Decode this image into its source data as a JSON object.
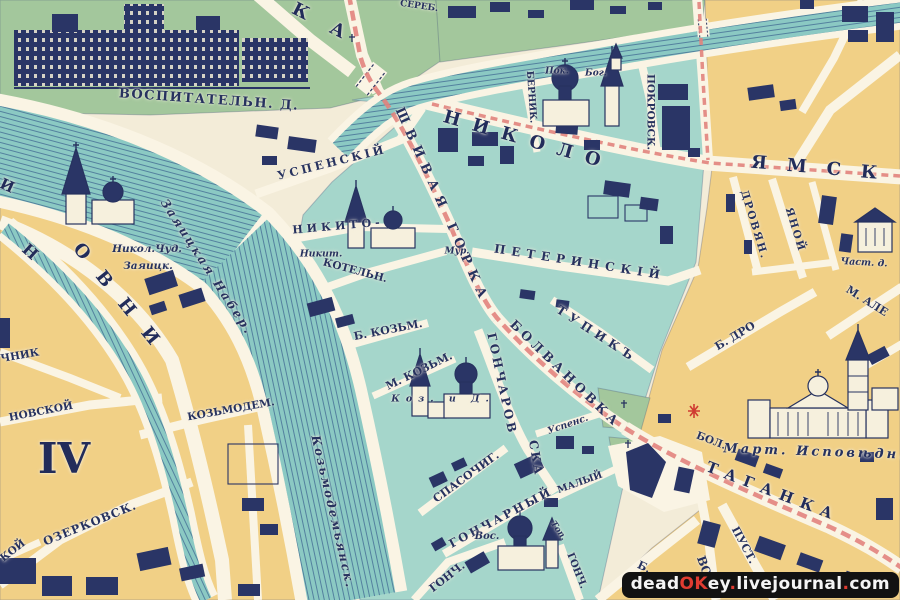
{
  "map": {
    "type": "historical-city-map",
    "district_number": "IV",
    "colors": {
      "parchment": "#f3ecd8",
      "street": "#faf4e4",
      "block_yellow": "#f1d086",
      "block_teal": "#a5d6cb",
      "block_green": "#a3c79c",
      "water": "#8bc9c3",
      "water_line": "#3c6490",
      "ink": "#27325f",
      "road_pink": "#e2837d",
      "accent_red": "#cf3a31",
      "watermark_bg": "#121212",
      "watermark_white": "#f5f5f5",
      "watermark_red": "#e03c31"
    },
    "labels": [
      {
        "name": "street-letter-partial",
        "text": "И",
        "x": 7,
        "y": 186,
        "rot": 25,
        "size": 15,
        "cls": "big"
      },
      {
        "name": "street-letter-n",
        "text": "Н",
        "x": 30,
        "y": 252,
        "rot": 42,
        "size": 16,
        "cls": "big"
      },
      {
        "name": "street-sadovnicheskaya-letters",
        "text": "ОВНИ",
        "x": 122,
        "y": 302,
        "rot": 51,
        "size": 18,
        "cls": "big",
        "sp": 20
      },
      {
        "name": "street-solyanka-letters",
        "text": "КА",
        "x": 330,
        "y": 27,
        "rot": 27,
        "size": 18,
        "cls": "big",
        "sp": 26
      },
      {
        "name": "label-vospitatelny-dom",
        "text": "ВОСПИТАТЕЛЬН. Д.",
        "x": 209,
        "y": 100,
        "rot": 4,
        "size": 13,
        "cls": "caps",
        "sp": 1.5
      },
      {
        "name": "street-serebryanicheskaya",
        "text": "СЕРЕБ.",
        "x": 419,
        "y": 7,
        "rot": 8,
        "size": 9,
        "cls": "caps"
      },
      {
        "name": "street-nikolo-letters",
        "text": "НИКОЛО",
        "x": 528,
        "y": 141,
        "rot": 16,
        "size": 18,
        "cls": "big",
        "sp": 13
      },
      {
        "name": "street-yamskaya-letters",
        "text": "ЯМСК",
        "x": 824,
        "y": 169,
        "rot": 5,
        "size": 18,
        "cls": "big",
        "sp": 20
      },
      {
        "name": "street-shvivaya-gorka",
        "text": "ШВИВАЯ ГОРКА",
        "x": 442,
        "y": 206,
        "rot": 66,
        "size": 13,
        "cls": "caps",
        "sp": 7
      },
      {
        "name": "street-bolvanovka",
        "text": "БОЛВАНОВКА",
        "x": 565,
        "y": 374,
        "rot": 44,
        "size": 12.5,
        "cls": "caps",
        "sp": 4
      },
      {
        "name": "street-taganka-letters",
        "text": "ТАГАНКА",
        "x": 773,
        "y": 492,
        "rot": 21,
        "size": 15,
        "cls": "big",
        "sp": 8
      },
      {
        "name": "street-bolshaya",
        "text": "БОЛ.",
        "x": 711,
        "y": 441,
        "rot": 21,
        "size": 10.5,
        "cls": "caps"
      },
      {
        "name": "church-martin-ispovednik-label",
        "text": "Март. Исповѣдн.",
        "x": 815,
        "y": 452,
        "rot": 2,
        "size": 13,
        "cls": "it",
        "sp": 3
      },
      {
        "name": "street-pustaya",
        "text": "ПУСТ.",
        "x": 744,
        "y": 545,
        "rot": 62,
        "size": 11,
        "cls": "caps"
      },
      {
        "name": "street-vorontsovskaya",
        "text": "ВО",
        "x": 704,
        "y": 566,
        "rot": 70,
        "size": 12,
        "cls": "caps"
      },
      {
        "name": "street-b-label",
        "text": "Б.",
        "x": 644,
        "y": 567,
        "rot": 25,
        "size": 11,
        "cls": "caps"
      },
      {
        "name": "street-tupik",
        "text": "ТУПИКЪ",
        "x": 597,
        "y": 334,
        "rot": 33,
        "size": 12,
        "cls": "caps",
        "sp": 5
      },
      {
        "name": "street-peterinsky",
        "text": "ПЕТЕРИНСКІЙ",
        "x": 580,
        "y": 262,
        "rot": 9,
        "size": 12,
        "cls": "caps",
        "sp": 6
      },
      {
        "name": "street-goncharovskaya",
        "text": "ГОНЧАРОВ",
        "x": 502,
        "y": 384,
        "rot": 78,
        "size": 12,
        "cls": "caps",
        "sp": 3
      },
      {
        "name": "street-goncharovskaya-2",
        "text": "СКА",
        "x": 536,
        "y": 458,
        "rot": 80,
        "size": 12,
        "cls": "caps",
        "sp": 2
      },
      {
        "name": "street-uspensky",
        "text": "УСПЕНСКІЙ",
        "x": 332,
        "y": 163,
        "rot": -14,
        "size": 11.5,
        "cls": "caps",
        "sp": 3
      },
      {
        "name": "street-nikito",
        "text": "НИКИТО-",
        "x": 338,
        "y": 226,
        "rot": -5,
        "size": 11,
        "cls": "caps",
        "sp": 4
      },
      {
        "name": "church-nikity-label",
        "text": "Никит.",
        "x": 321,
        "y": 254,
        "rot": 0,
        "size": 9.5,
        "cls": "it"
      },
      {
        "name": "label-mur",
        "text": "Мур.",
        "x": 457,
        "y": 252,
        "rot": 0,
        "size": 9,
        "cls": "it"
      },
      {
        "name": "street-kotelnichesky",
        "text": "КОТЕЛЬН.",
        "x": 355,
        "y": 271,
        "rot": 15,
        "size": 10.5,
        "cls": "caps"
      },
      {
        "name": "street-pokrovsky",
        "text": "ПОКРОВСК.",
        "x": 650,
        "y": 112,
        "rot": 90,
        "size": 10.5,
        "cls": "caps"
      },
      {
        "name": "street-bernikovsky",
        "text": "БЕРНИК.",
        "x": 531,
        "y": 97,
        "rot": 86,
        "size": 9.5,
        "cls": "caps"
      },
      {
        "name": "church-pokrova-label",
        "text": "Пок.",
        "x": 557,
        "y": 72,
        "rot": 0,
        "size": 9,
        "cls": "it"
      },
      {
        "name": "church-bogoroditsy-label",
        "text": "Бог.",
        "x": 596,
        "y": 74,
        "rot": 0,
        "size": 9,
        "cls": "it"
      },
      {
        "name": "street-b-kozmodemyansky",
        "text": "Б. КОЗЬМ.",
        "x": 388,
        "y": 330,
        "rot": -11,
        "size": 11,
        "cls": "caps"
      },
      {
        "name": "street-m-kozmodemyansky",
        "text": "М. КОЗЬМ.",
        "x": 419,
        "y": 371,
        "rot": -26,
        "size": 11,
        "cls": "caps"
      },
      {
        "name": "church-kozmy-i-damiana-label",
        "text": "Коз. и Д.",
        "x": 443,
        "y": 399,
        "rot": 0,
        "size": 9.5,
        "cls": "it",
        "sp": 6
      },
      {
        "name": "street-spasochigasovsky",
        "text": "СПАСОЧИГ.",
        "x": 466,
        "y": 477,
        "rot": -36,
        "size": 11,
        "cls": "caps"
      },
      {
        "name": "street-goncharny",
        "text": "ГОНЧАРНЫЙ",
        "x": 501,
        "y": 518,
        "rot": -28,
        "size": 11.5,
        "cls": "caps",
        "sp": 2.5
      },
      {
        "name": "street-maly",
        "text": "МАЛЫЙ",
        "x": 580,
        "y": 483,
        "rot": -20,
        "size": 9.5,
        "cls": "caps"
      },
      {
        "name": "label-uspens",
        "text": "Успенс.",
        "x": 568,
        "y": 425,
        "rot": -19,
        "size": 9.5,
        "cls": "it"
      },
      {
        "name": "church-voskreseniya-label",
        "text": "Вос.",
        "x": 487,
        "y": 537,
        "rot": 0,
        "size": 10,
        "cls": "it"
      },
      {
        "name": "street-goncharnaya",
        "text": "ГОНЧ.",
        "x": 447,
        "y": 577,
        "rot": -38,
        "size": 11,
        "cls": "caps"
      },
      {
        "name": "street-gonch-2",
        "text": "ГОНЧ.",
        "x": 576,
        "y": 571,
        "rot": 68,
        "size": 10,
        "cls": "caps"
      },
      {
        "name": "label-top",
        "text": "Топ.",
        "x": 558,
        "y": 531,
        "rot": 55,
        "size": 8.5,
        "cls": "it"
      },
      {
        "name": "street-zayaitskaya-nab",
        "text": "Заяицкая Набер.",
        "x": 207,
        "y": 267,
        "rot": 57,
        "size": 12,
        "cls": "it",
        "sp": 2.5
      },
      {
        "name": "street-kozmodemyanskaya-nab",
        "text": "Козьмодемьянск.",
        "x": 333,
        "y": 512,
        "rot": 77,
        "size": 12,
        "cls": "it",
        "sp": 2
      },
      {
        "name": "street-kozmodemyanskaya",
        "text": "КОЗЬМОДЕМ.",
        "x": 231,
        "y": 410,
        "rot": -10,
        "size": 10.5,
        "cls": "caps"
      },
      {
        "name": "church-nikola-zayaitsky-label-1",
        "text": "Никол.Чуд.",
        "x": 147,
        "y": 249,
        "rot": 0,
        "size": 10.5,
        "cls": "it"
      },
      {
        "name": "church-nikola-zayaitsky-label-2",
        "text": "Заяицк.",
        "x": 148,
        "y": 266,
        "rot": 0,
        "size": 10.5,
        "cls": "it"
      },
      {
        "name": "district-number",
        "text": "IV",
        "x": 64,
        "y": 459,
        "rot": 0,
        "size": 42,
        "cls": "big"
      },
      {
        "name": "street-chnik",
        "text": "ЧНИК",
        "x": 20,
        "y": 356,
        "rot": -10,
        "size": 10.5,
        "cls": "caps"
      },
      {
        "name": "street-novskoy",
        "text": "НОВСКОЙ",
        "x": 41,
        "y": 412,
        "rot": -11,
        "size": 10.5,
        "cls": "caps"
      },
      {
        "name": "street-ozerkovsky",
        "text": "ОЗЕРКОВСК.",
        "x": 90,
        "y": 524,
        "rot": -22,
        "size": 11.5,
        "cls": "caps",
        "sp": 1
      },
      {
        "name": "street-koy",
        "text": "КОЙ",
        "x": 13,
        "y": 551,
        "rot": -38,
        "size": 10.5,
        "cls": "caps"
      },
      {
        "name": "street-drovyanoy-1",
        "text": "ДРОВЯН.",
        "x": 754,
        "y": 225,
        "rot": 73,
        "size": 10.5,
        "cls": "caps",
        "sp": 2
      },
      {
        "name": "street-drovyanoy-2",
        "text": "ЯНОЙ",
        "x": 795,
        "y": 230,
        "rot": 73,
        "size": 10.5,
        "cls": "caps",
        "sp": 2
      },
      {
        "name": "street-b-drovyanoy",
        "text": "Б. ДРО",
        "x": 735,
        "y": 336,
        "rot": -31,
        "size": 11,
        "cls": "caps"
      },
      {
        "name": "street-m-alekseevskaya",
        "text": "М. АЛЕ",
        "x": 867,
        "y": 301,
        "rot": 32,
        "size": 11,
        "cls": "caps"
      },
      {
        "name": "label-chastny-dom",
        "text": "Част. д.",
        "x": 864,
        "y": 263,
        "rot": 3,
        "size": 9.5,
        "cls": "it"
      }
    ],
    "watermark": {
      "parts": [
        {
          "text": "dead",
          "color": "white"
        },
        {
          "text": "OK",
          "color": "red"
        },
        {
          "text": "ey",
          "color": "white"
        },
        {
          "text": ".",
          "color": "red"
        },
        {
          "text": "livejournal",
          "color": "white"
        },
        {
          "text": ".",
          "color": "red"
        },
        {
          "text": "com",
          "color": "white"
        }
      ]
    }
  }
}
